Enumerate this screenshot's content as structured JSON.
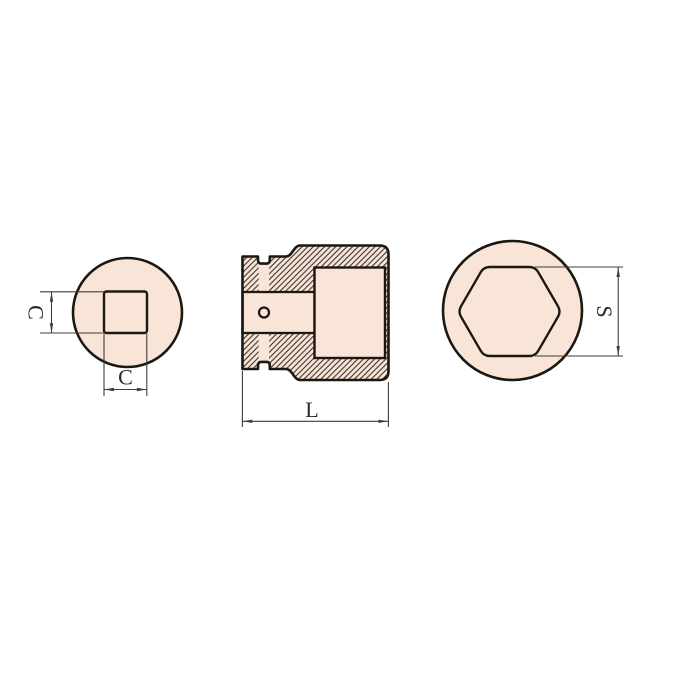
{
  "drawing": {
    "labels": {
      "c_vertical": "C",
      "c_horizontal": "C",
      "length": "L",
      "hex_size": "S"
    },
    "colors": {
      "fill": "#f9e5d7",
      "outline": "#1b1712",
      "hatch": "#2a251f",
      "dimension": "#3d3d3d",
      "background": "#ffffff"
    }
  }
}
